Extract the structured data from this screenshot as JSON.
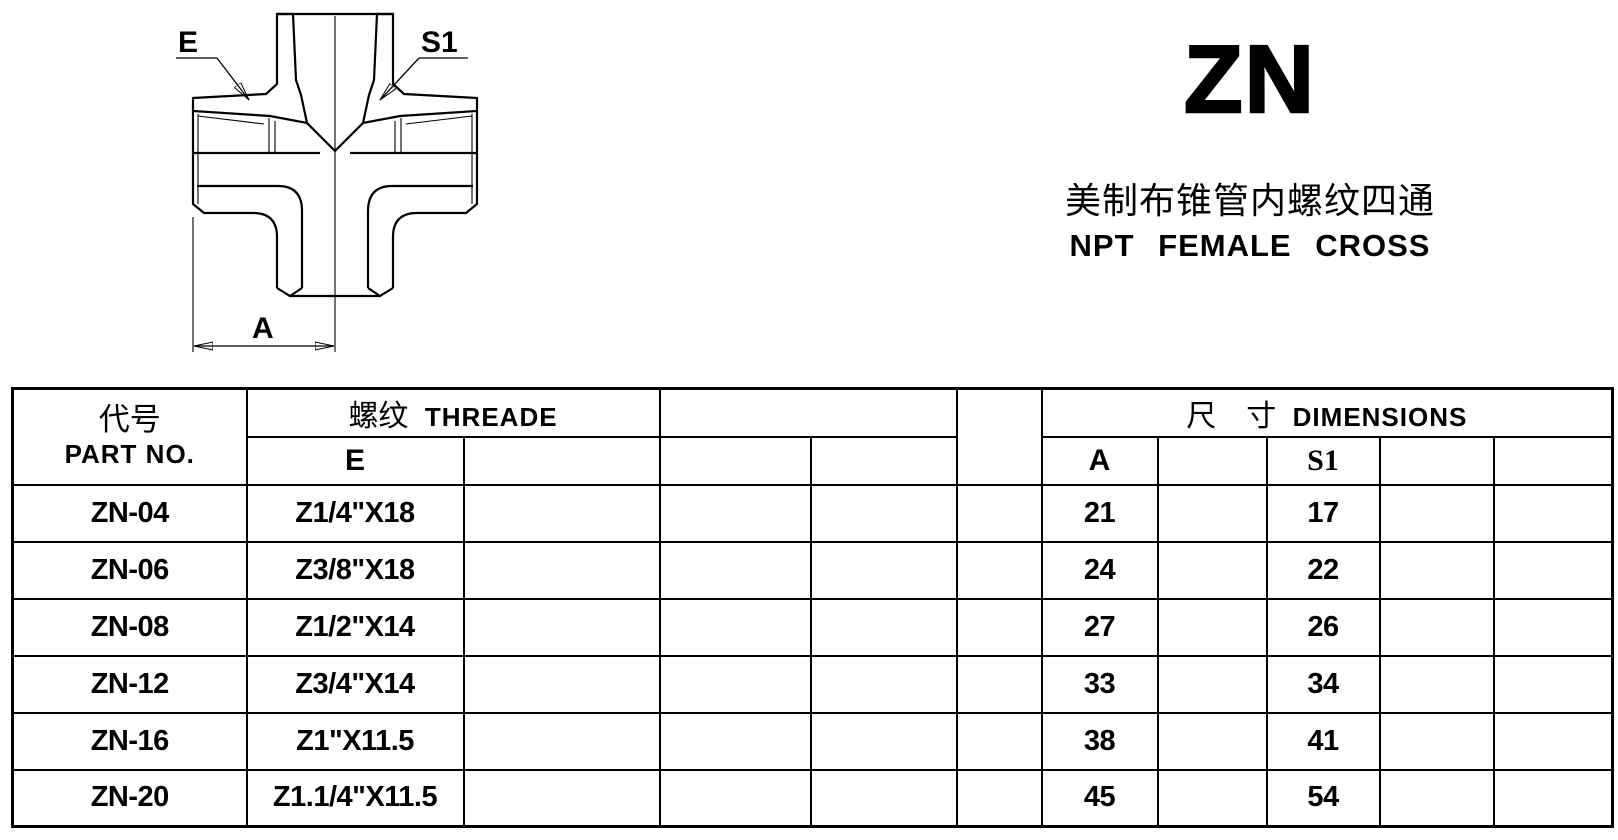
{
  "page": {
    "paper_color": "#ffffff",
    "ink_color": "#000000"
  },
  "title_block": {
    "series_code": "ZN",
    "subtitle_zh": "美制布锥管内螺纹四通",
    "subtitle_en": "NPT FEMALE CROSS"
  },
  "drawing": {
    "labels": {
      "thread": "E",
      "wrench": "S1",
      "width_dim": "A"
    }
  },
  "table": {
    "header": {
      "part_no_zh": "代号",
      "part_no_en": "PART NO.",
      "thread_zh": "螺纹",
      "thread_en": "THREADE",
      "thread_sub": "E",
      "dims_zh": "尺　寸",
      "dims_en": "DIMENSIONS",
      "dim_a": "A",
      "dim_s1": "S1"
    },
    "rows": [
      {
        "part_no": "ZN-04",
        "e": "Z1/4\"X18",
        "a": "21",
        "s1": "17"
      },
      {
        "part_no": "ZN-06",
        "e": "Z3/8\"X18",
        "a": "24",
        "s1": "22"
      },
      {
        "part_no": "ZN-08",
        "e": "Z1/2\"X14",
        "a": "27",
        "s1": "26"
      },
      {
        "part_no": "ZN-12",
        "e": "Z3/4\"X14",
        "a": "33",
        "s1": "34"
      },
      {
        "part_no": "ZN-16",
        "e": "Z1\"X11.5",
        "a": "38",
        "s1": "41"
      },
      {
        "part_no": "ZN-20",
        "e": "Z1.1/4\"X11.5",
        "a": "45",
        "s1": "54"
      }
    ]
  }
}
